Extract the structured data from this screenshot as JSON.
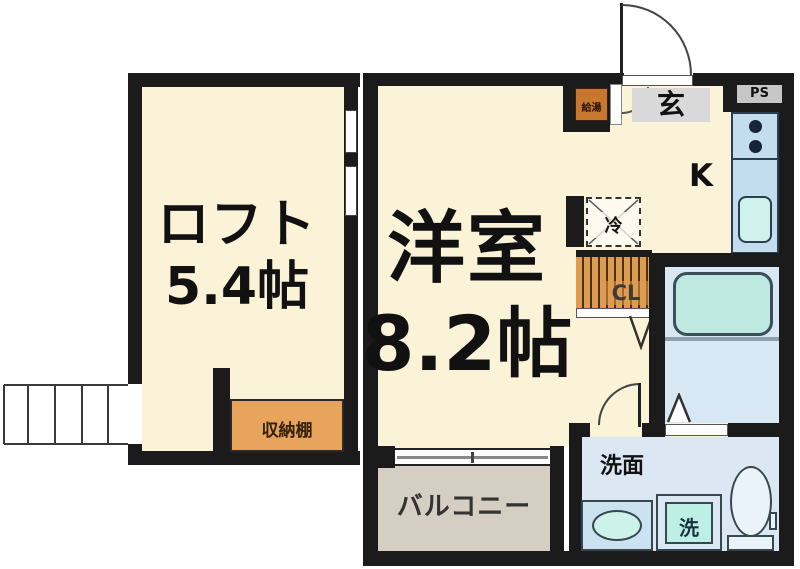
{
  "labels": {
    "loft_name": "ロフト",
    "loft_size": "5.4帖",
    "room_name": "洋室",
    "room_size": "8.2帖",
    "kitchen": "K",
    "entrance": "玄",
    "pipe_space": "PS",
    "water_heater": "給湯",
    "refrigerator": "冷",
    "closet": "CL",
    "storage_shelf": "収納棚",
    "balcony": "バルコニー",
    "washroom": "洗面",
    "washer": "洗"
  },
  "colors": {
    "wall": "#1b1b1b",
    "room_fill": "#faf3d8",
    "balcony_fill": "#d5cec2",
    "wet_area_fill": "#dbe8f4",
    "counter_fill": "#c3ddef",
    "fixture_cyan": "#c8f0e8",
    "tub_fill": "#bee9e1",
    "accent_orange": "#e09b4f",
    "entrance_gray": "#d9d9d9"
  }
}
